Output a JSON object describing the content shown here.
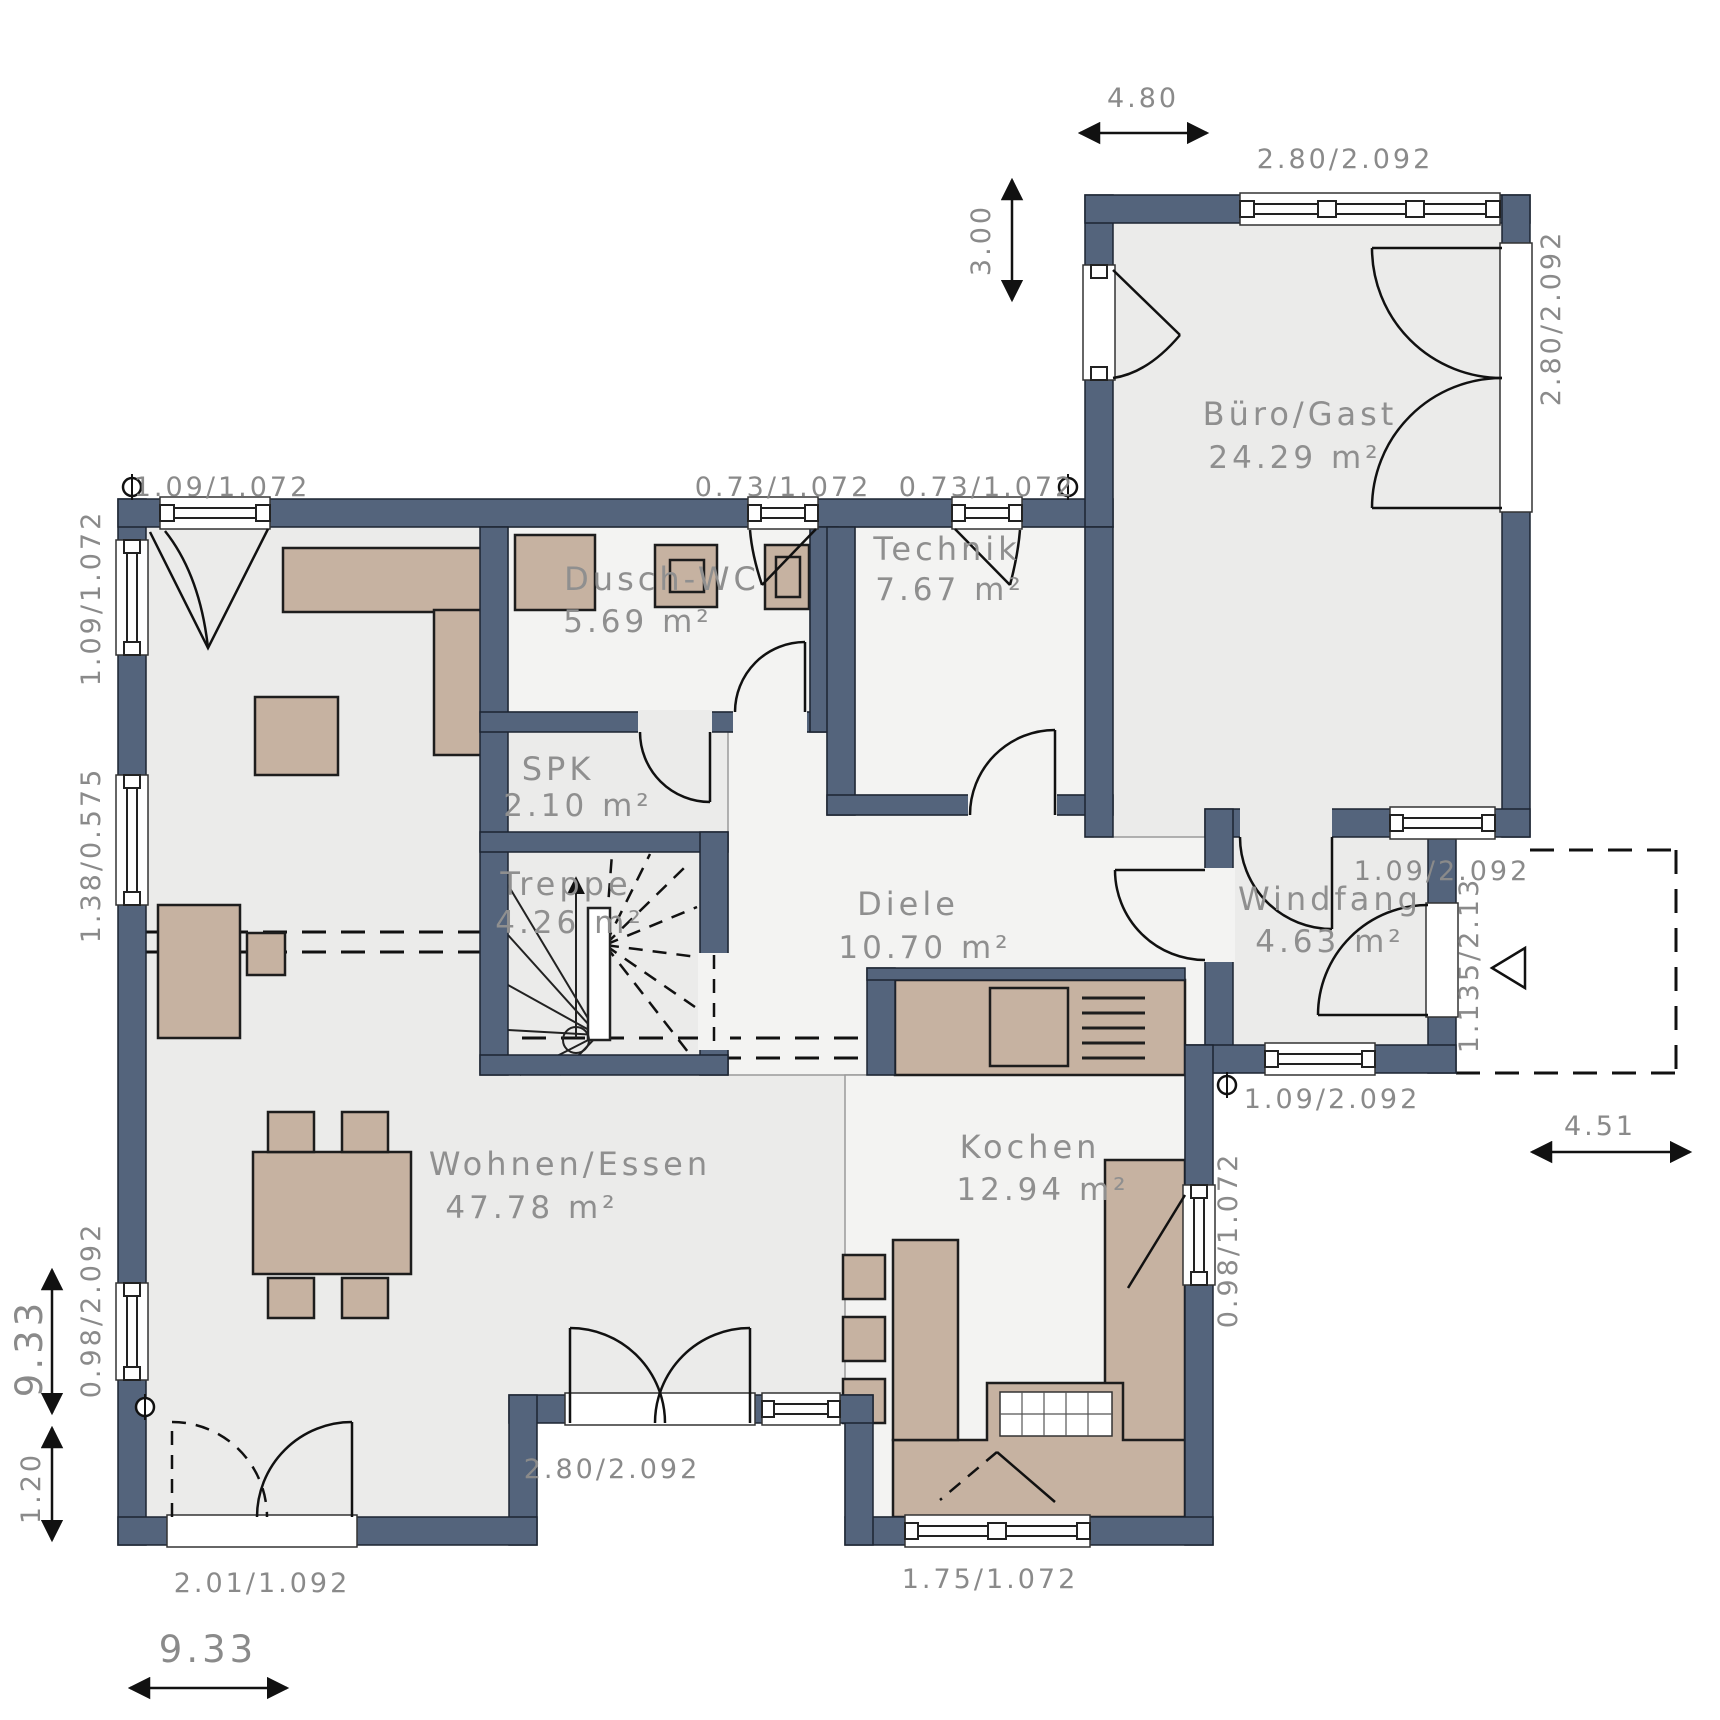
{
  "plan": {
    "rooms": {
      "buero": {
        "name": "Büro/Gast",
        "area": "24.29 m²"
      },
      "technik": {
        "name": "Technik",
        "area": "7.67 m²"
      },
      "dusch_wc": {
        "name": "Dusch-WC",
        "area": "5.69 m²"
      },
      "spk": {
        "name": "SPK",
        "area": "2.10 m²"
      },
      "treppe": {
        "name": "Treppe",
        "area": "4.26 m²"
      },
      "diele": {
        "name": "Diele",
        "area": "10.70 m²"
      },
      "windfang": {
        "name": "Windfang",
        "area": "4.63 m²"
      },
      "wohnen": {
        "name": "Wohnen/Essen",
        "area": "47.78 m²"
      },
      "kochen": {
        "name": "Kochen",
        "area": "12.94 m²"
      }
    },
    "dimensions": {
      "wing_width": "4.80",
      "wing_depth": "3.00",
      "left_height": "9.33",
      "left_extra": "1.20",
      "bottom_width": "9.33",
      "right_width": "4.51"
    },
    "openings": {
      "top_left": "1.09/1.072",
      "top_wc": "0.73/1.072",
      "top_technik": "0.73/1.072",
      "left_top": "1.09/1.072",
      "left_mid": "1.38/0.575",
      "left_bottom": "0.98/2.092",
      "wing_top": "2.80/2.092",
      "wing_right": "2.80/2.092",
      "wing_bottom": "1.09/2.092",
      "entry_door": "1.135/2.13",
      "windfang_bottom": "1.09/2.092",
      "kitchen_east": "0.98/1.072",
      "kitchen_bottom": "1.75/1.072",
      "terrace_door": "2.80/2.092",
      "patio_left": "2.01/1.092"
    },
    "colors": {
      "wall": "#54647c",
      "floor": "#ebebea",
      "tile_floor": "#f3f3f2",
      "furniture": "#c6b2a1",
      "label": "#8f8f8f"
    }
  }
}
